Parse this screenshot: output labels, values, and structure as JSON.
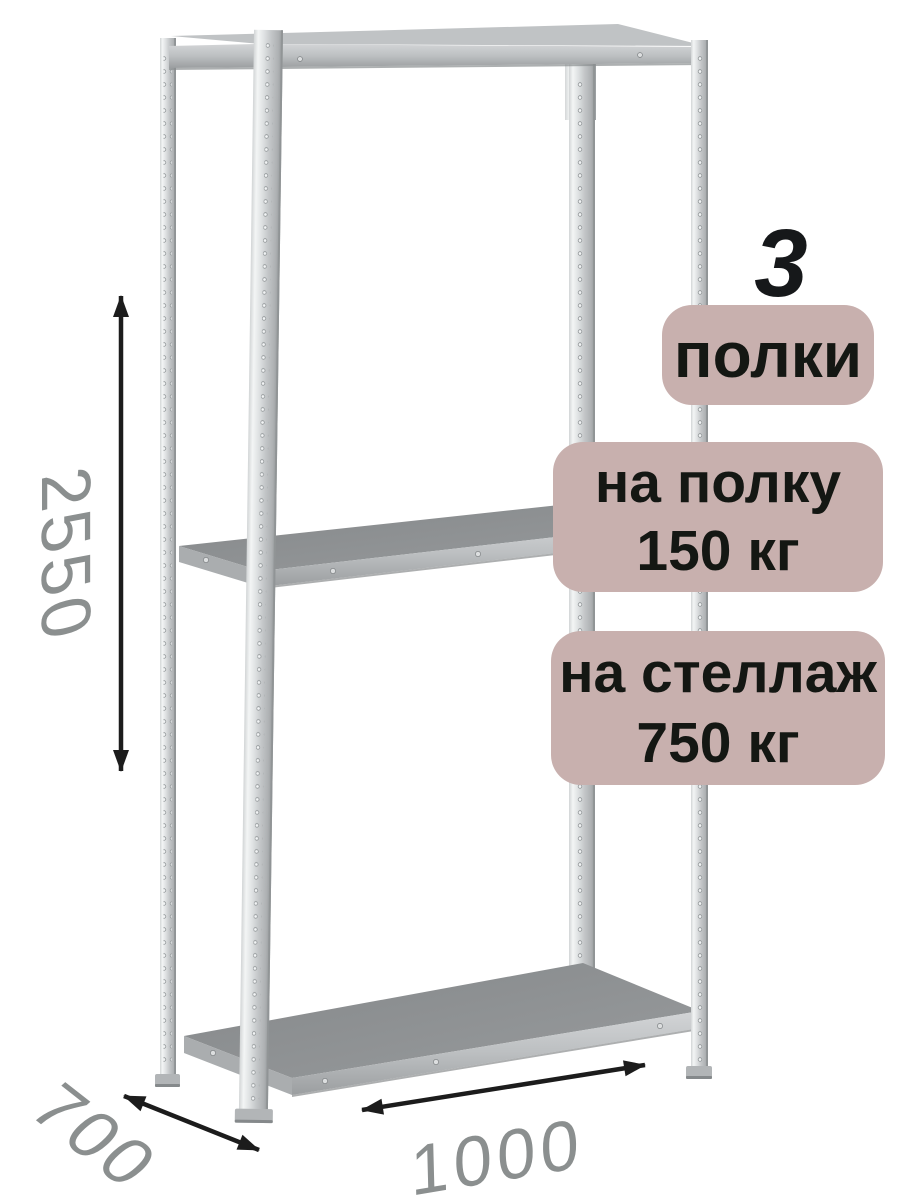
{
  "badges": {
    "shelves_count": "3",
    "shelves_label": "полки",
    "shelf_load": {
      "line1": "на полку",
      "line2": "150 кг"
    },
    "rack_load": {
      "line1": "на стеллаж",
      "line2": "750 кг"
    }
  },
  "dimensions": {
    "height_mm": "2550",
    "depth_mm": "700",
    "width_mm": "1000"
  },
  "icons": {
    "height_arrow": "double-headed-vertical-arrow",
    "depth_arrow": "double-headed-diagonal-arrow",
    "width_arrow": "double-headed-horizontal-arrow"
  },
  "colors": {
    "background": "#ffffff",
    "badge_bg": "#c8b0ae",
    "badge_text": "#141713",
    "count_text": "#16181a",
    "dimension_text": "#8b8f8f",
    "arrow": "#1c1c1c",
    "metal_light": "#f3f5f5",
    "metal_mid": "#c3c6c8",
    "metal_dark": "#94989a",
    "shelf_top": "#8c8f91",
    "shelf_edge": "#bcbfc1"
  }
}
